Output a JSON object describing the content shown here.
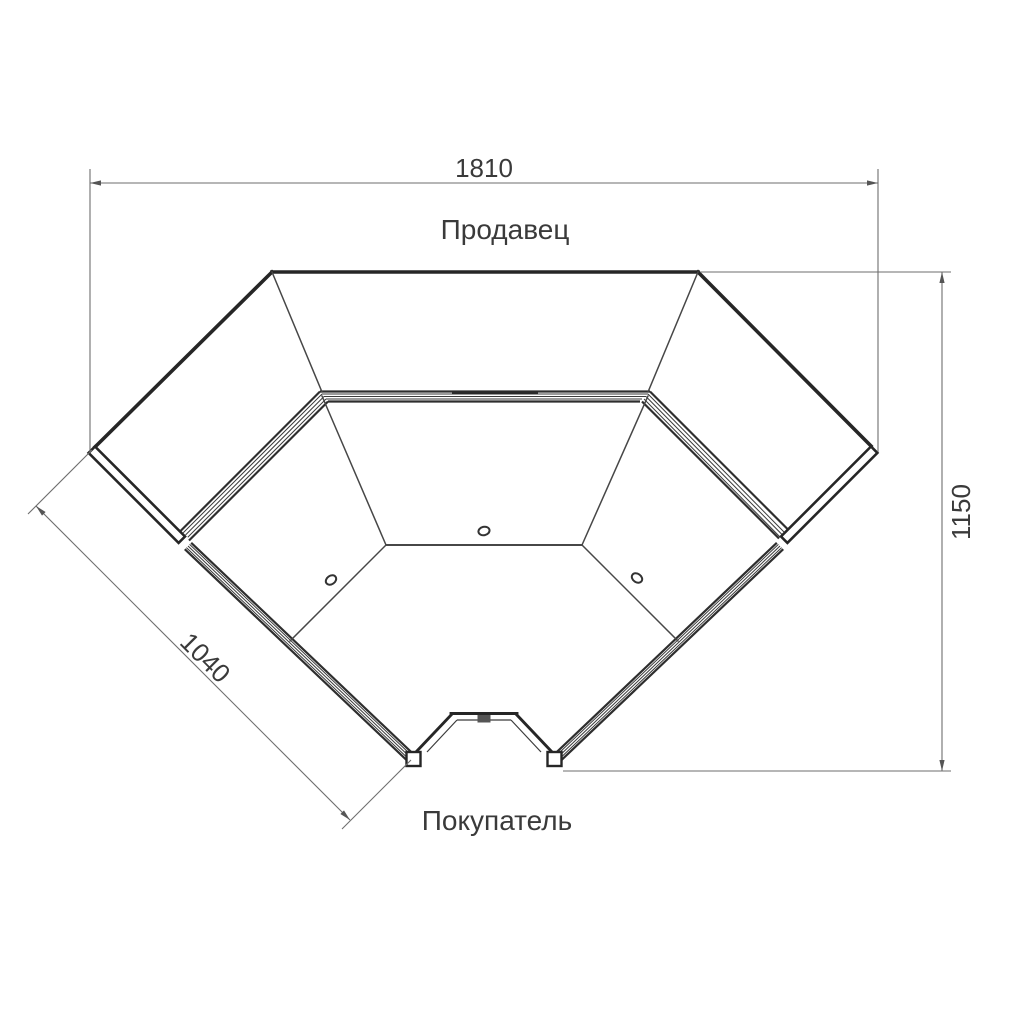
{
  "drawing": {
    "labels": {
      "seller": "Продавец",
      "buyer": "Покупатель"
    },
    "dimensions": {
      "overall_width": "1810",
      "overall_depth": "1150",
      "front_left_edge": "1040"
    },
    "colors": {
      "outline": "#262626",
      "thin_line": "#474747",
      "dimension_line": "#6e6e6e",
      "text": "#3a3a3a",
      "background": "#ffffff"
    }
  }
}
